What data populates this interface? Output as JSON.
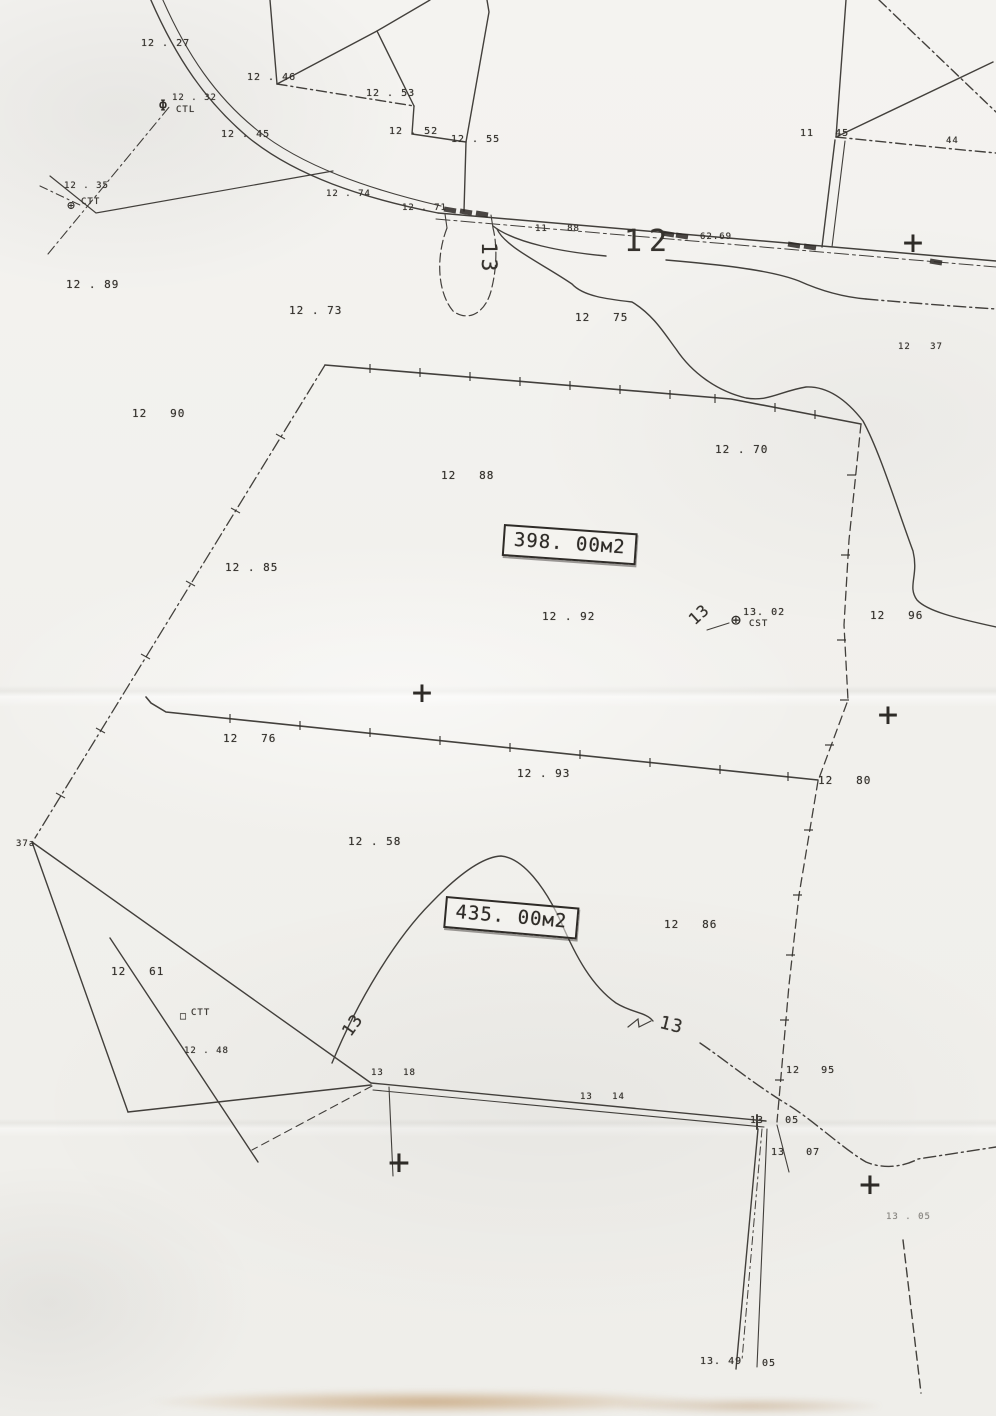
{
  "colors": {
    "paper": "#f2f1ed",
    "ink": "#2f2c28",
    "stain": "#b5874a"
  },
  "parcels": [
    {
      "area_label": "398. 00м2"
    },
    {
      "area_label": "435. 00м2"
    }
  ],
  "labels": [
    {
      "name": "spot-elevation",
      "text": "12 . 27",
      "x": 141,
      "y": 39,
      "size": 10
    },
    {
      "name": "spot-elevation",
      "text": "12 . 46",
      "x": 247,
      "y": 73,
      "size": 10
    },
    {
      "name": "spot-elevation",
      "text": "12 . 53",
      "x": 366,
      "y": 89,
      "size": 10
    },
    {
      "name": "spot-elevation",
      "text": "12 . 52",
      "x": 389,
      "y": 127,
      "size": 10
    },
    {
      "name": "spot-elevation",
      "text": "12 . 55",
      "x": 451,
      "y": 135,
      "size": 10
    },
    {
      "name": "spot-elevation",
      "text": "12 . 32",
      "x": 172,
      "y": 94,
      "size": 9
    },
    {
      "name": "station-label",
      "text": "CTL",
      "x": 176,
      "y": 106,
      "size": 9
    },
    {
      "name": "spot-elevation",
      "text": "12 . 45",
      "x": 221,
      "y": 130,
      "size": 10
    },
    {
      "name": "spot-elevation",
      "text": "12 . 35",
      "x": 64,
      "y": 182,
      "size": 9
    },
    {
      "name": "station-label",
      "text": "CTT",
      "x": 81,
      "y": 198,
      "size": 9
    },
    {
      "name": "spot-elevation",
      "text": "12 . 89",
      "x": 66,
      "y": 279
    },
    {
      "name": "spot-elevation",
      "text": "12 . 73",
      "x": 289,
      "y": 305
    },
    {
      "name": "spot-elevation",
      "text": "12   75",
      "x": 575,
      "y": 312
    },
    {
      "name": "spot-elevation",
      "text": "12   90",
      "x": 132,
      "y": 408
    },
    {
      "name": "spot-elevation",
      "text": "12   37",
      "x": 898,
      "y": 343,
      "size": 9
    },
    {
      "name": "spot-elevation",
      "text": "11   88",
      "x": 535,
      "y": 225,
      "size": 9
    },
    {
      "name": "spot-elevation",
      "text": "11   45",
      "x": 800,
      "y": 129,
      "size": 10
    },
    {
      "name": "spot-elevation",
      "text": "44",
      "x": 946,
      "y": 137,
      "size": 9
    },
    {
      "name": "spot-elevation",
      "text": "12 . 74",
      "x": 326,
      "y": 190,
      "size": 9
    },
    {
      "name": "spot-elevation",
      "text": "12 . 71",
      "x": 402,
      "y": 204,
      "size": 9
    },
    {
      "name": "road-annotation",
      "text": "62.69",
      "x": 700,
      "y": 233,
      "size": 9
    },
    {
      "name": "contour-label-12",
      "text": "12",
      "x": 624,
      "y": 226,
      "size": 30,
      "ls": 7
    },
    {
      "name": "contour-label-13",
      "text": "13",
      "x": 500,
      "y": 242,
      "size": 21,
      "rot": 90,
      "ls": 4
    },
    {
      "name": "spot-elevation",
      "text": "12   88",
      "x": 441,
      "y": 470
    },
    {
      "name": "spot-elevation",
      "text": "12 . 70",
      "x": 715,
      "y": 444
    },
    {
      "name": "parcel-area-398",
      "text": "398. 00м2",
      "x": 504,
      "y": 524,
      "box": true,
      "rot": 4,
      "size": 19
    },
    {
      "name": "spot-elevation",
      "text": "12 . 85",
      "x": 225,
      "y": 562
    },
    {
      "name": "spot-elevation",
      "text": "12 . 92",
      "x": 542,
      "y": 611
    },
    {
      "name": "spot-elevation",
      "text": "13. 02",
      "x": 743,
      "y": 608,
      "size": 10
    },
    {
      "name": "station-label",
      "text": "CST",
      "x": 749,
      "y": 620,
      "size": 9
    },
    {
      "name": "contour-label-13",
      "text": "13",
      "x": 686,
      "y": 616,
      "size": 16,
      "rot": -42
    },
    {
      "name": "spot-elevation",
      "text": "12   96",
      "x": 870,
      "y": 610
    },
    {
      "name": "spot-elevation",
      "text": "12   76",
      "x": 223,
      "y": 733
    },
    {
      "name": "spot-elevation",
      "text": "12 . 93",
      "x": 517,
      "y": 768
    },
    {
      "name": "spot-elevation",
      "text": "12   80",
      "x": 818,
      "y": 775
    },
    {
      "name": "spot-elevation",
      "text": "12 . 58",
      "x": 348,
      "y": 836
    },
    {
      "name": "parcel-area-435",
      "text": "435. 00м2",
      "x": 446,
      "y": 896,
      "box": true,
      "rot": 5,
      "size": 19
    },
    {
      "name": "spot-elevation",
      "text": "12   86",
      "x": 664,
      "y": 919
    },
    {
      "name": "spot-elevation",
      "text": "12   61",
      "x": 111,
      "y": 966
    },
    {
      "name": "station-label",
      "text": "CTT",
      "x": 191,
      "y": 1009,
      "size": 9
    },
    {
      "name": "spot-elevation",
      "text": "12 . 48",
      "x": 184,
      "y": 1047,
      "size": 9
    },
    {
      "name": "spot-elevation",
      "text": "13   18",
      "x": 371,
      "y": 1069,
      "size": 9
    },
    {
      "name": "spot-elevation",
      "text": "13   14",
      "x": 580,
      "y": 1093,
      "size": 9
    },
    {
      "name": "contour-label-13",
      "text": "13",
      "x": 340,
      "y": 1030,
      "size": 17,
      "rot": -55
    },
    {
      "name": "contour-label-13",
      "text": "13",
      "x": 662,
      "y": 1014,
      "size": 18,
      "rot": 14
    },
    {
      "name": "spot-elevation",
      "text": "12   95",
      "x": 786,
      "y": 1066,
      "size": 10
    },
    {
      "name": "spot-elevation",
      "text": "13   05",
      "x": 750,
      "y": 1116,
      "size": 10
    },
    {
      "name": "spot-elevation",
      "text": "13   07",
      "x": 771,
      "y": 1148,
      "size": 10
    },
    {
      "name": "spot-elevation",
      "text": "13. 49",
      "x": 700,
      "y": 1357,
      "size": 10
    },
    {
      "name": "spot-elevation",
      "text": "05",
      "x": 762,
      "y": 1359,
      "size": 10
    },
    {
      "name": "spot-elevation",
      "text": "13 . 05",
      "x": 886,
      "y": 1213,
      "size": 9,
      "cls": "faint"
    },
    {
      "name": "parcel-number",
      "text": "37a",
      "x": 16,
      "y": 840,
      "size": 9
    }
  ],
  "symbols": [
    {
      "name": "grid-cross",
      "glyph": "+",
      "x": 913,
      "y": 243,
      "size": 34
    },
    {
      "name": "grid-cross",
      "glyph": "+",
      "x": 422,
      "y": 693,
      "size": 34
    },
    {
      "name": "grid-cross",
      "glyph": "+",
      "x": 888,
      "y": 715,
      "size": 34
    },
    {
      "name": "grid-cross",
      "glyph": "+",
      "x": 399,
      "y": 1163,
      "size": 36
    },
    {
      "name": "grid-cross",
      "glyph": "+",
      "x": 870,
      "y": 1185,
      "size": 36
    },
    {
      "name": "survey-point-icon",
      "glyph": "⊕",
      "x": 736,
      "y": 621,
      "size": 17
    },
    {
      "name": "survey-point-icon",
      "glyph": "⊕",
      "x": 71,
      "y": 206,
      "size": 13
    },
    {
      "name": "survey-point-icon",
      "glyph": "Φ",
      "x": 163,
      "y": 106,
      "size": 15
    },
    {
      "name": "survey-marker-icon",
      "glyph": "□",
      "x": 183,
      "y": 1017,
      "size": 10
    }
  ]
}
